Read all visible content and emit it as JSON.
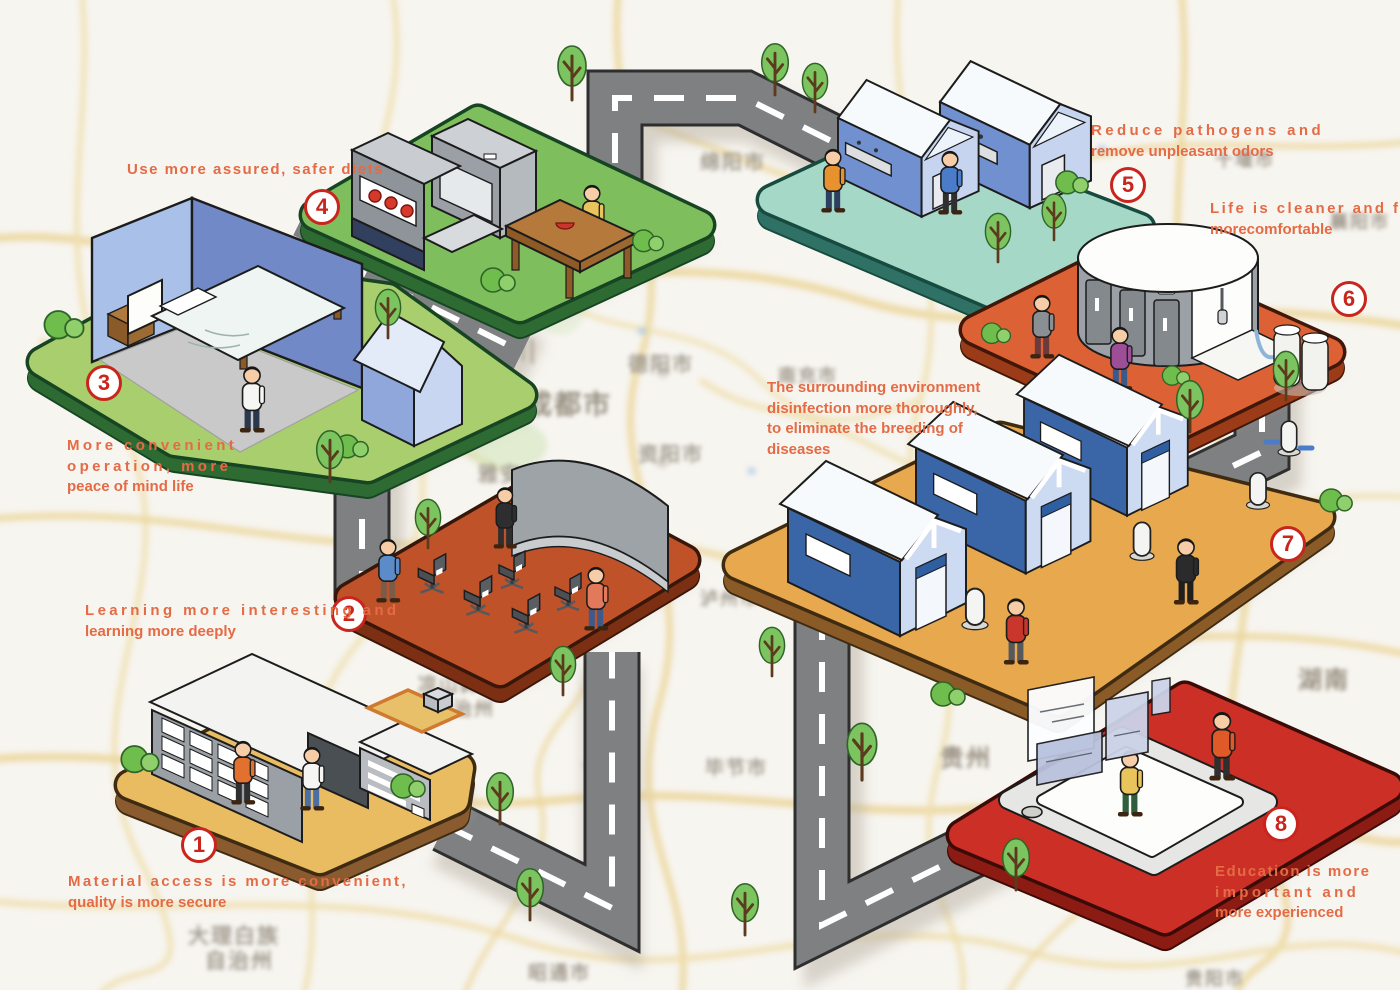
{
  "stations": [
    {
      "number": "1",
      "caption_lines": [
        "Material access is more convenient,",
        "quality is more secure"
      ],
      "scene": "warehouse with two people"
    },
    {
      "number": "2",
      "caption_lines": [
        "Learning more interesting and",
        "learning more deeply"
      ],
      "scene": "classroom with chairs and curved screen"
    },
    {
      "number": "3",
      "caption_lines": [
        "More convenient",
        "operation, more",
        "peace of mind life"
      ],
      "scene": "bedroom with bed and person"
    },
    {
      "number": "4",
      "caption_lines": [
        "Use more assured, safer diets"
      ],
      "scene": "kitchen with fridge and dining table"
    },
    {
      "number": "5",
      "caption_lines": [
        "Reduce pathogens and",
        "remove unpleasant odors"
      ],
      "scene": "wash houses with sinks"
    },
    {
      "number": "6",
      "caption_lines": [
        "Life is cleaner and feel",
        "morecomfortable"
      ],
      "scene": "rounded public washroom"
    },
    {
      "number": "7",
      "caption_lines": [
        "The surrounding environment",
        "disinfection more thoroughly,",
        "to eliminate the breeding of",
        "diseases"
      ],
      "scene": "three houses with sanitizer dispensers"
    },
    {
      "number": "8",
      "caption_lines": [
        "Education is more",
        "important and",
        "more experienced"
      ],
      "scene": "giant tablet with floating screens"
    }
  ],
  "map": {
    "labels": [
      {
        "text": "绵阳市"
      },
      {
        "text": "十堰市"
      },
      {
        "text": "襄阳市"
      },
      {
        "text": "四川"
      },
      {
        "text": "德阳市"
      },
      {
        "text": "成都市"
      },
      {
        "text": "资阳市"
      },
      {
        "text": "雅安"
      },
      {
        "text": "南充市"
      },
      {
        "text": "泸州市"
      },
      {
        "text": "凉山彝族"
      },
      {
        "text": "自治州"
      },
      {
        "text": "毕节市"
      },
      {
        "text": "贵州"
      },
      {
        "text": "湖南"
      },
      {
        "text": "大理白族"
      },
      {
        "text": "自治州"
      },
      {
        "text": "昭通市"
      },
      {
        "text": "贵阳市"
      }
    ]
  },
  "colors": {
    "accent_text": "#E46B45",
    "badge_red": "#C9251C",
    "road_gray": "#7F8082",
    "map_road_yellow": "#ECD79E",
    "platform_tops": [
      "#E9BC62",
      "#BF5229",
      "#A8CE6E",
      "#7FBE5D",
      "#A5D8C6",
      "#DC6134",
      "#E8A94E",
      "#CC2F26"
    ]
  }
}
